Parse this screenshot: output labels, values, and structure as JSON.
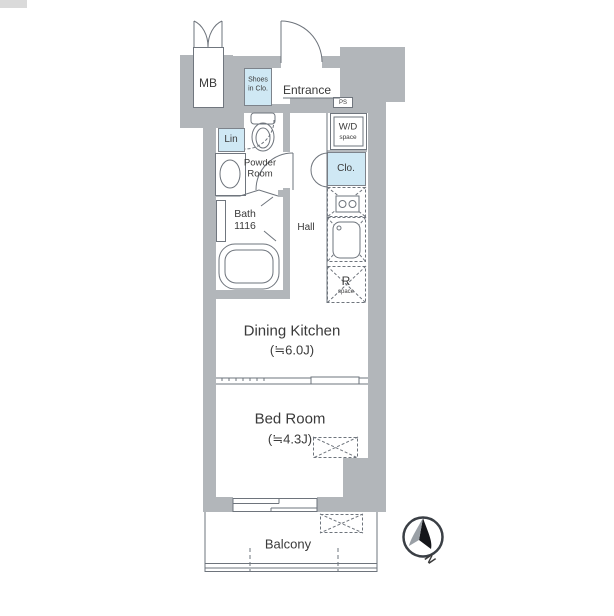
{
  "meta": {
    "type": "apartment-floor-plan"
  },
  "colors": {
    "wall_gray": "#b2b6ba",
    "storage_blue": "#cfe8f4",
    "line": "#6e747c",
    "text": "#3a3a3a"
  },
  "rooms": {
    "mb": {
      "label": "MB"
    },
    "shoes_closet": {
      "label_line1": "Shoes",
      "label_line2": "in Clo."
    },
    "entrance": {
      "label": "Entrance"
    },
    "ps": {
      "label": "PS"
    },
    "wd_space": {
      "label_line1": "W/D",
      "label_line2": "space"
    },
    "linen": {
      "label": "Lin"
    },
    "powder_room": {
      "label_line1": "Powder",
      "label_line2": "Room"
    },
    "closet": {
      "label": "Clo."
    },
    "bath": {
      "label_line1": "Bath",
      "label_line2": "1116"
    },
    "hall": {
      "label": "Hall"
    },
    "refrigerator_space": {
      "label_line1": "R",
      "label_line2": "space"
    },
    "dining_kitchen": {
      "label": "Dining Kitchen",
      "size": "(≒6.0J)"
    },
    "bed_room": {
      "label": "Bed Room",
      "size": "(≒4.3J)"
    },
    "balcony": {
      "label": "Balcony"
    }
  },
  "compass": {
    "label": "N"
  }
}
